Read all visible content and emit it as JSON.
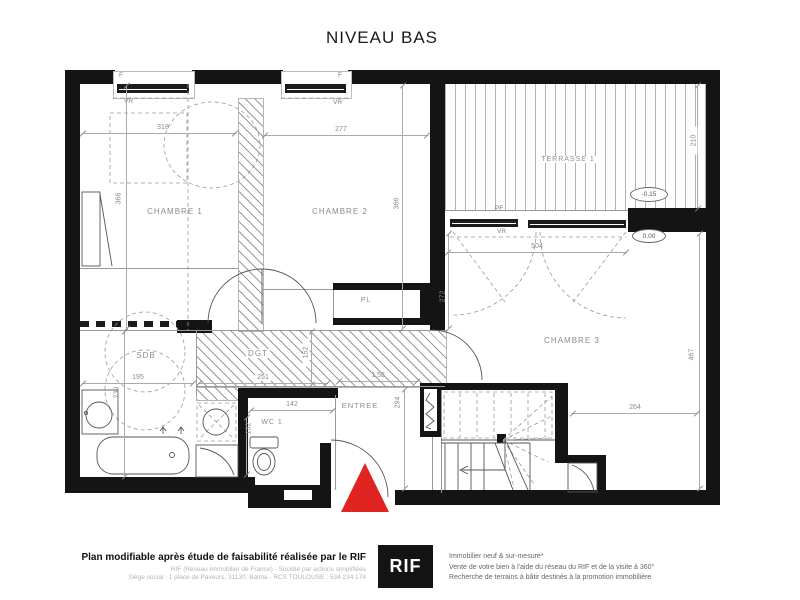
{
  "title": "NIVEAU BAS",
  "rooms": {
    "chambre1": "CHAMBRE 1",
    "chambre2": "CHAMBRE 2",
    "chambre3": "CHAMBRE 3",
    "terrasse": "TERRASSE 1",
    "sdb": "SDB",
    "dgt": "DGT",
    "wc": "WC 1",
    "entree": "ENTREE",
    "placard": "PL"
  },
  "dims": {
    "chambre1_w": "318",
    "chambre1_h": "366",
    "chambre2_w": "277",
    "chambre2_h": "366",
    "terrasse_depth": "210",
    "chambre3_top": "504",
    "chambre3_left": "272",
    "chambre3_right": "467",
    "chambre3_bottom": "264",
    "sdb_w": "195",
    "sdb_h": "239",
    "dgt_w": "251",
    "dgt_h": "152",
    "wc_w": "142",
    "wc_h": "132",
    "entree_w": "1.58",
    "entree_h": "294"
  },
  "openings": {
    "window": "F",
    "roller_shutter": "VR",
    "french_window": "PF"
  },
  "levels": {
    "terrace": "-0.15",
    "ground": "0.00"
  },
  "footer": {
    "disclaimer": "Plan modifiable après étude de faisabilité réalisée par le RIF",
    "company_line1": "RIF (Réseau Immobilier de France) - Société par actions simplifiées",
    "company_line2": "Siège social : 1 place de Paveurs, 31130, Balma - RCS TOULOUSE : 534 234 174",
    "logo": "RIF",
    "services_line1": "Immobilier neuf & sur-mesure*",
    "services_line2": "Vente de votre bien à l'aide du réseau du RIF et de la visite à 360°",
    "services_line3": "Recherche de terrains à bâtir destinés à la promotion immobilière"
  },
  "colors": {
    "wall": "#141414",
    "entrance_marker": "#e02421",
    "logo_bg": "#141414",
    "dim_text": "#8a8a8a"
  }
}
